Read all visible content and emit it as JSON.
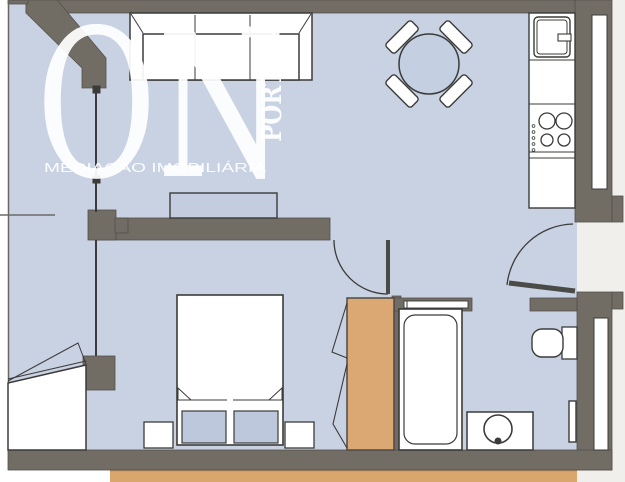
{
  "watermark": {
    "brand_main": "ON",
    "brand_vertical": "PORT – –",
    "tagline": "MEDIAÇÃO IMOBILIÁRIA"
  },
  "colors": {
    "wall": "#716c64",
    "wall_edge": "#55514b",
    "floor": "#c9d2e2",
    "outside_right": "#f1efec",
    "outside_left": "#ffffff",
    "wood": "#dba873",
    "terrace": "#d9a76e",
    "furniture_outline": "#3b3b39",
    "furniture_fill": "#ffffff",
    "cushion": "#bdc8dc",
    "watermark": "#ffffff"
  },
  "floorplan": {
    "type": "apartment-floor-plan",
    "rooms": [
      "living-dining-room",
      "kitchen",
      "bedroom",
      "bathroom",
      "enclosed-balcony",
      "hall"
    ],
    "furniture": [
      "sofa",
      "round-dining-table",
      "dining-chairs-x4",
      "kitchen-counter",
      "kitchen-sink",
      "cooktop-4-burners",
      "sideboard",
      "double-bed",
      "pillows-x2",
      "nightstands-x2",
      "wardrobe",
      "bathtub",
      "washbasin",
      "toilet",
      "towel-radiator",
      "entrance-door",
      "bedroom-door",
      "sliding-bathroom-door",
      "bay-window",
      "windows-x2"
    ]
  }
}
